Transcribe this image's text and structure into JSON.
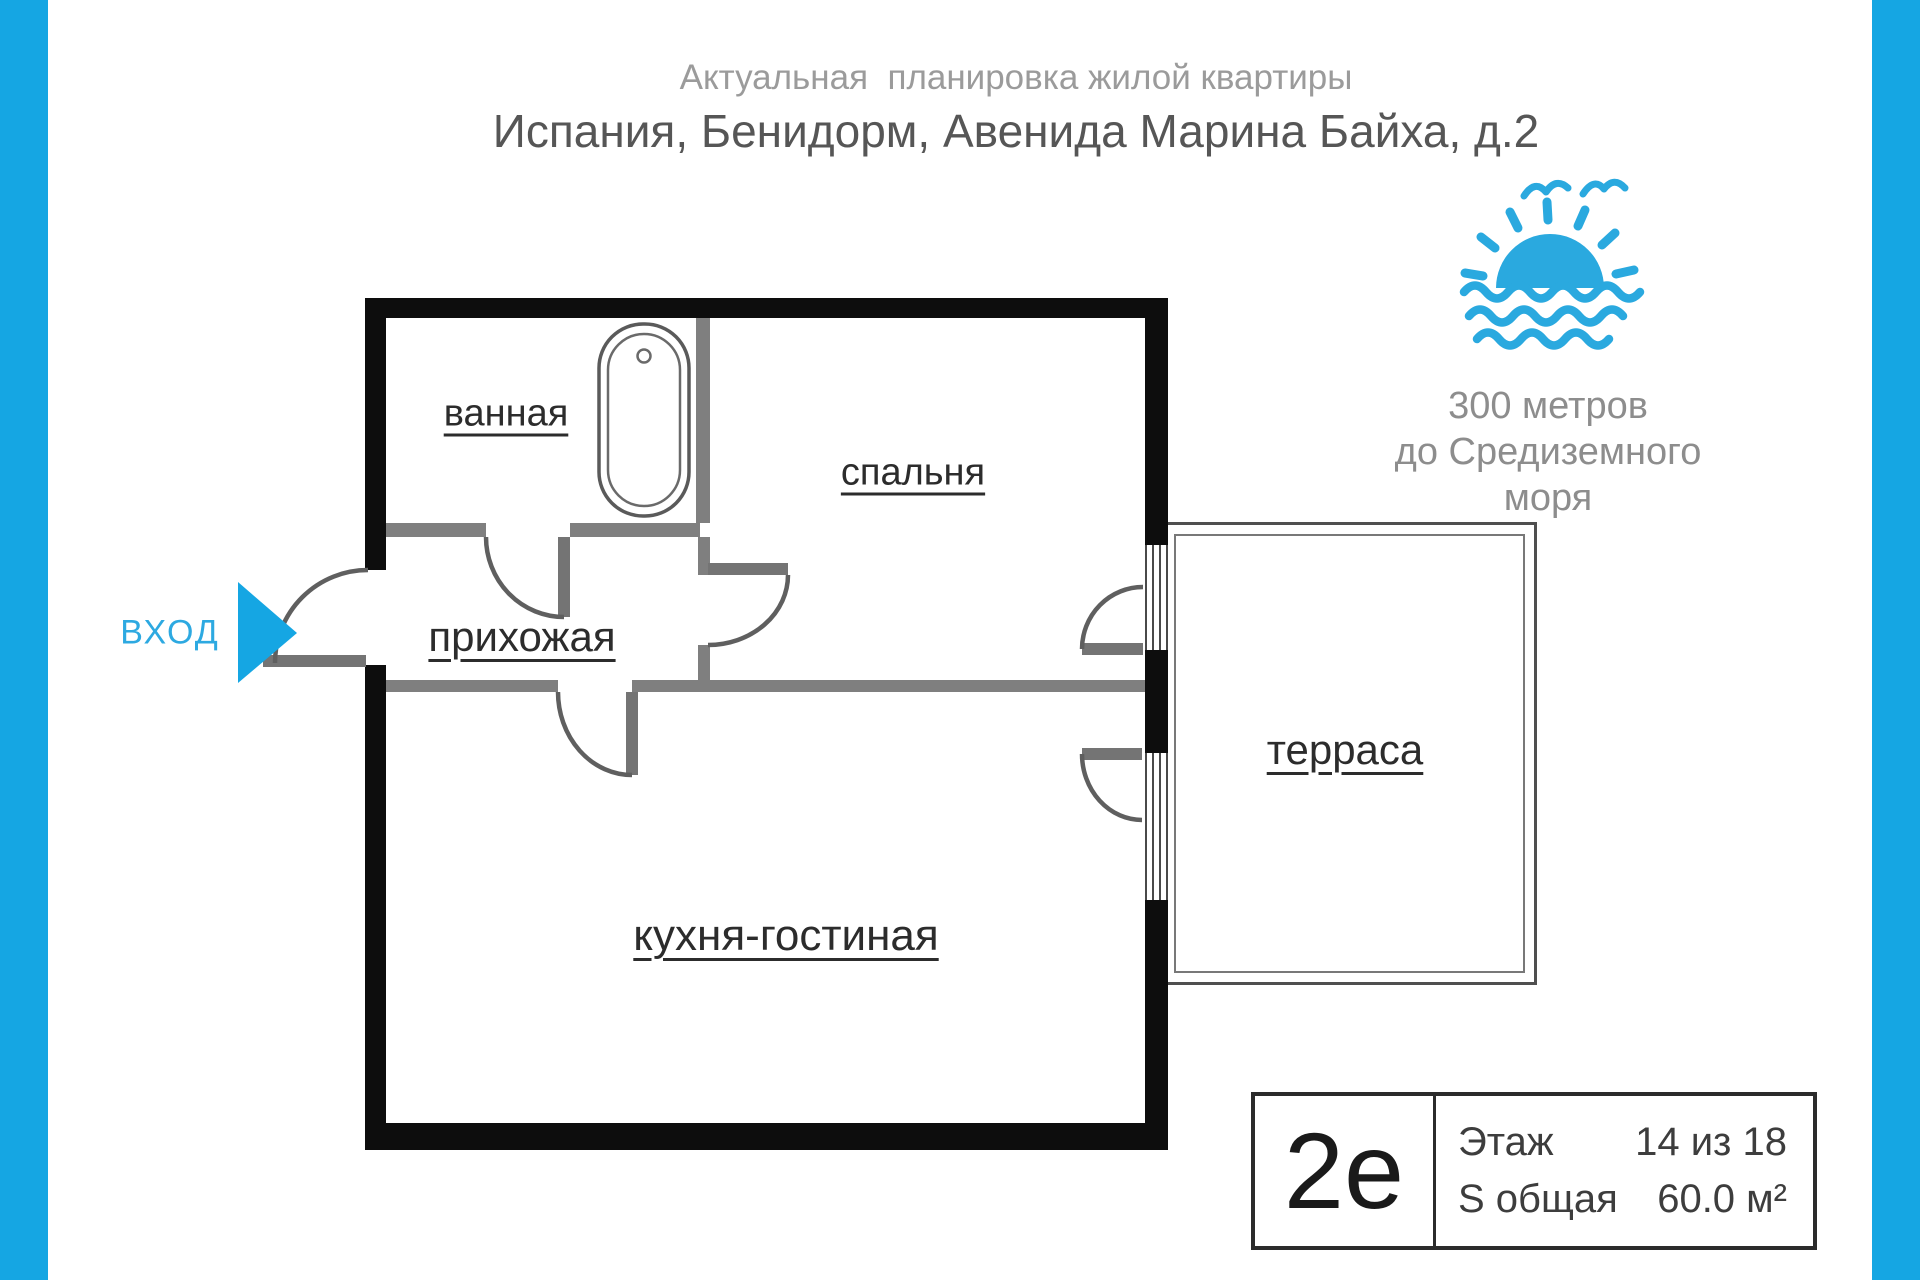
{
  "page": {
    "title_line1": "Актуальная  планировка жилой квартиры",
    "title_line2": "Испания, Бенидорм, Авенида Марина Байха, д.2"
  },
  "colors": {
    "accent_blue": "#15a6e3",
    "wall_black": "#0d0d0d",
    "interior_wall_gray": "#7f7f7f"
  },
  "seaside": {
    "icon": "sun-over-sea-icon",
    "line1": "300 метров",
    "line2": "до Средиземного моря"
  },
  "entrance": {
    "label": "ВХОД",
    "arrow_icon": "entrance-arrow-icon"
  },
  "rooms": {
    "bathroom": "ванная",
    "bedroom": "спальня",
    "hallway": "прихожая",
    "kitchen_living": "кухня-гостиная",
    "terrace": "терраса"
  },
  "info_box": {
    "apartment_type": "2е",
    "floor_label": "Этаж",
    "floor_value": "14 из 18",
    "area_label": "S общая",
    "area_value": "60.0 м²"
  }
}
